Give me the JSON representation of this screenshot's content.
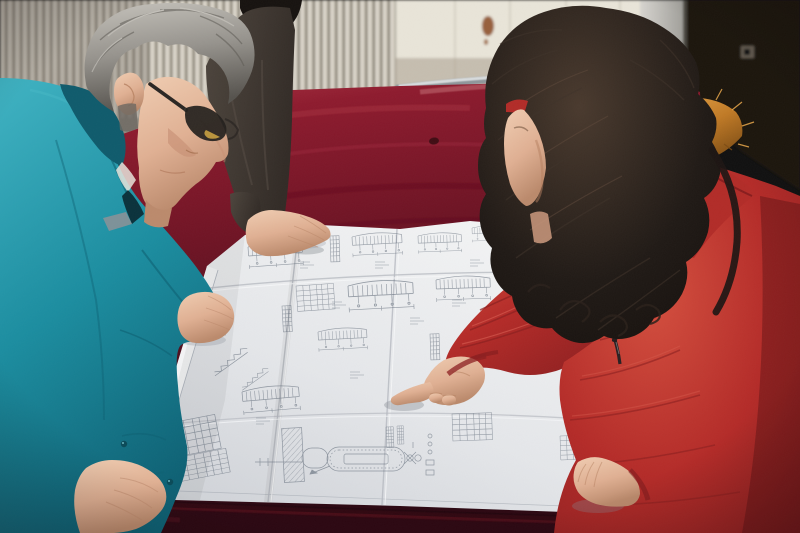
{
  "scene": {
    "label": "three-people-reviewing-a-large-technical-blueprint-on-a-red-velvet-table",
    "people": [
      {
        "label": "man-gray-hair-glasses-teal-work-jacket",
        "position": "left-foreground",
        "pose": "leaning-over-drawing-hands-on-paper"
      },
      {
        "label": "person-dark-jacket-black-hair",
        "position": "behind-man",
        "pose": "hand-resting-on-drawing"
      },
      {
        "label": "woman-long-dark-hair-red-down-coat-fur-hood",
        "position": "right-foreground",
        "pose": "pointing-index-finger-at-drawing"
      }
    ],
    "objects": [
      {
        "label": "blueprint-sheet",
        "detail": "large folded white engineering drawing with beam elevations, schedules, stair sections, tank detail"
      },
      {
        "label": "red-velvet-table",
        "detail": "crimson velvet covered table, dark front edge"
      },
      {
        "label": "metal-trim",
        "detail": "chrome band along far table edge"
      },
      {
        "label": "radiator-panel",
        "detail": "cream vertical-fin radiator behind table"
      },
      {
        "label": "white-door-panel",
        "detail": "pale wall panel with rust stain"
      },
      {
        "label": "dark-door-panel",
        "detail": "near-black panel with small latch, right side"
      }
    ]
  },
  "palette": {
    "radiator_fin": "#d6d0c3",
    "radiator_gap": "#837d70",
    "wall_blur": "#928e83",
    "door_white": "#e9e5d9",
    "plank_line": "#c9c3b5",
    "stain": "#8a4a22",
    "frame_light": "#d7d5d0",
    "frame_dark": "#9b9a95",
    "dark_wall": "#1b1511",
    "latch": "#6a6257",
    "metal_trim": "#d8dcde",
    "metal_trim_dark": "#8f979b",
    "velvet_hilite": "#b43c4c",
    "velvet_top": "#8e1b2e",
    "velvet_mid": "#6e1424",
    "velvet_front": "#45101e",
    "velvet_deep": "#2c0812",
    "paper_bright": "#f2f3f4",
    "paper": "#e5e7ea",
    "paper_shade": "#d2d5da",
    "paper_crease": "#b7bbc2",
    "ink": "#5f6a78",
    "teal_light": "#3db1c1",
    "teal": "#1b8da0",
    "teal_dark": "#0d6073",
    "collar_navy": "#0f5b6c",
    "collar_deep": "#0a323c",
    "shirt_white": "#e8e4dc",
    "skin_light": "#f0cdb2",
    "skin": "#e0b093",
    "skin_shadow": "#bb8a6c",
    "hair_gray_light": "#c6c3bc",
    "hair_gray": "#96938d",
    "hair_gray_dark": "#55524d",
    "glasses_black": "#23201d",
    "glasses_glint": "#c9a040",
    "dark_jacket_hi": "#4e463e",
    "dark_jacket": "#322b26",
    "black_hair": "#171310",
    "woman_hair_hi": "#4a3a2e",
    "woman_hair": "#201a16",
    "fur_light": "#eaa94c",
    "fur": "#c07a26",
    "fur_dark": "#7c4c14",
    "coat_red_light": "#d5503f",
    "coat_red": "#b42b28",
    "coat_red_dark": "#8c1f20",
    "coat_red_deep": "#661314",
    "zipper_black": "#241c1e"
  }
}
